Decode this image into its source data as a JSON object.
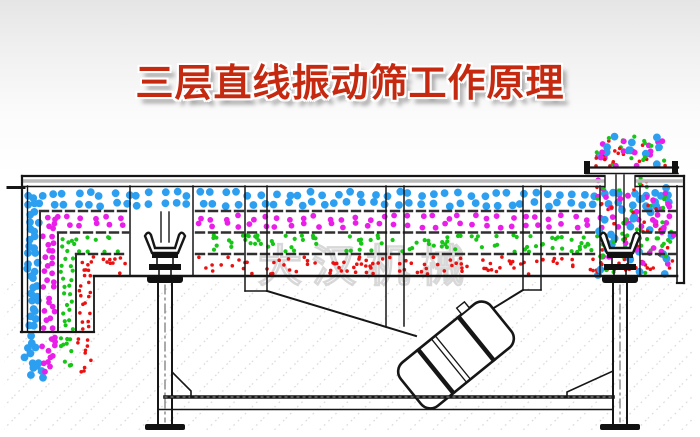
{
  "title": {
    "text": "三层直线振动筛工作原理"
  },
  "watermark": {
    "text": "大汉机械"
  },
  "colors": {
    "title_red": "#c5290f",
    "line": "#161616",
    "blue": "#2d9ff0",
    "magenta": "#e91ee9",
    "green": "#17c517",
    "red": "#ea1111"
  },
  "particles": {
    "seed": 11,
    "radius": {
      "blue": 3.9,
      "magenta": 2.9,
      "green": 2.1,
      "red": 1.8
    },
    "mix_weights": {
      "blue": 0.26,
      "magenta": 0.28,
      "green": 0.24,
      "red": 0.22
    },
    "groups": [
      {
        "name": "top-deck-blue-oversize",
        "color": "blue",
        "mode": "rows",
        "rows": 2,
        "count": 104,
        "region": [
          34,
          189,
          642,
          20
        ]
      },
      {
        "name": "deck2-magenta-mid",
        "color": "magenta",
        "mode": "rows",
        "rows": 2,
        "count": 96,
        "region": [
          50,
          214,
          624,
          15
        ],
        "exclude": [
          [
            128,
            196
          ]
        ]
      },
      {
        "name": "deck3-green-fine",
        "color": "green",
        "mode": "scatter",
        "count": 135,
        "region": [
          68,
          235,
          606,
          17
        ],
        "exclude": [
          [
            128,
            196
          ]
        ]
      },
      {
        "name": "bottom-pan-red-finest",
        "color": "red",
        "mode": "scatter",
        "count": 150,
        "region": [
          86,
          257,
          588,
          17
        ],
        "exclude": [
          [
            128,
            196
          ]
        ]
      },
      {
        "name": "chute-blue-column",
        "color": "blue",
        "mode": "rows",
        "rows": 17,
        "count": 34,
        "region": [
          28,
          193,
          11,
          138
        ]
      },
      {
        "name": "chute-blue-outfall",
        "color": "blue",
        "mode": "scatter",
        "count": 13,
        "region": [
          24,
          334,
          20,
          44
        ]
      },
      {
        "name": "chute-magenta-column",
        "color": "magenta",
        "mode": "rows",
        "rows": 15,
        "count": 30,
        "region": [
          43,
          216,
          12,
          115
        ]
      },
      {
        "name": "chute-magenta-outfall",
        "color": "magenta",
        "mode": "scatter",
        "count": 12,
        "region": [
          41,
          334,
          17,
          42
        ]
      },
      {
        "name": "chute-green-column",
        "color": "green",
        "mode": "rows",
        "rows": 12,
        "count": 24,
        "region": [
          61,
          237,
          12,
          94
        ]
      },
      {
        "name": "chute-green-outfall",
        "color": "green",
        "mode": "scatter",
        "count": 10,
        "region": [
          59,
          334,
          15,
          36
        ]
      },
      {
        "name": "chute-red-column",
        "color": "red",
        "mode": "rows",
        "rows": 10,
        "count": 20,
        "region": [
          79,
          258,
          12,
          73
        ]
      },
      {
        "name": "chute-red-outfall",
        "color": "red",
        "mode": "scatter",
        "count": 10,
        "region": [
          77,
          334,
          14,
          38
        ]
      },
      {
        "name": "feed-cloud-mixed",
        "color": "mix",
        "mode": "scatter",
        "count": 62,
        "region": [
          596,
          136,
          70,
          30
        ]
      },
      {
        "name": "feed-stream-mixed",
        "color": "mix",
        "mode": "scatter",
        "count": 132,
        "region": [
          597,
          177,
          78,
          99
        ]
      }
    ]
  }
}
